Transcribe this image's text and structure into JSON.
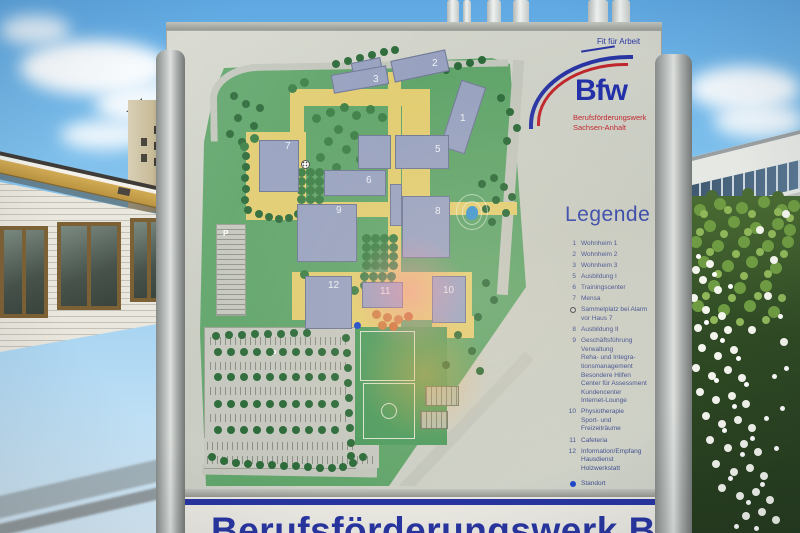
{
  "sign": {
    "logo": {
      "tagline": "Fit für Arbeit",
      "brand": "Bfw",
      "org_line1": "Berufsförderungswerk",
      "org_line2": "Sachsen-Anhalt"
    },
    "legend": {
      "title": "Legende",
      "items": [
        {
          "num": "1",
          "label": "Wohnheim 1"
        },
        {
          "num": "2",
          "label": "Wohnheim 2"
        },
        {
          "num": "3",
          "label": "Wohnheim 3"
        },
        {
          "num": "5",
          "label": "Ausbildung I"
        },
        {
          "num": "6",
          "label": "Trainingscenter"
        },
        {
          "num": "7",
          "label": "Mensa"
        },
        {
          "num": "",
          "symbol": "assembly-point",
          "label": "Sammelplatz bei Alarm\nvor Haus 7"
        },
        {
          "num": "8",
          "label": "Ausbildung II"
        },
        {
          "num": "9",
          "label": "Geschäftsführung\nVerwaltung\nReha- und Integra-\ntionsmanagement\nBesondere Hilfen\nCenter für Assessment\nKundencenter\nInternet-Lounge"
        },
        {
          "num": "10",
          "label": "Physiotherapie\nSport- und\nFreizeiträume"
        },
        {
          "num": "11",
          "label": "Cafeteria"
        },
        {
          "num": "12",
          "label": "Information/Empfang\nHausdienst\nHolzwerkstatt"
        },
        {
          "num": "",
          "symbol": "location-dot",
          "label": "Standort"
        }
      ]
    },
    "map": {
      "building_labels": [
        "1",
        "2",
        "3",
        "5",
        "6",
        "7",
        "8",
        "9",
        "10",
        "11",
        "12"
      ],
      "parking_labels": [
        "P",
        "P"
      ]
    },
    "footer": {
      "partial_text": "Berufsförderungswerk Bfw"
    }
  },
  "colors": {
    "brand_blue": "#2330a8",
    "brand_red": "#c0272d",
    "legend_text": "#414f8f",
    "campus_green": "#61a56b",
    "path_yellow": "#e2cd72",
    "building_fill": "#98a2c0",
    "water_blue": "#3f96cf",
    "standort_blue": "#1b46c9",
    "footer_blue": "#2835a0"
  }
}
